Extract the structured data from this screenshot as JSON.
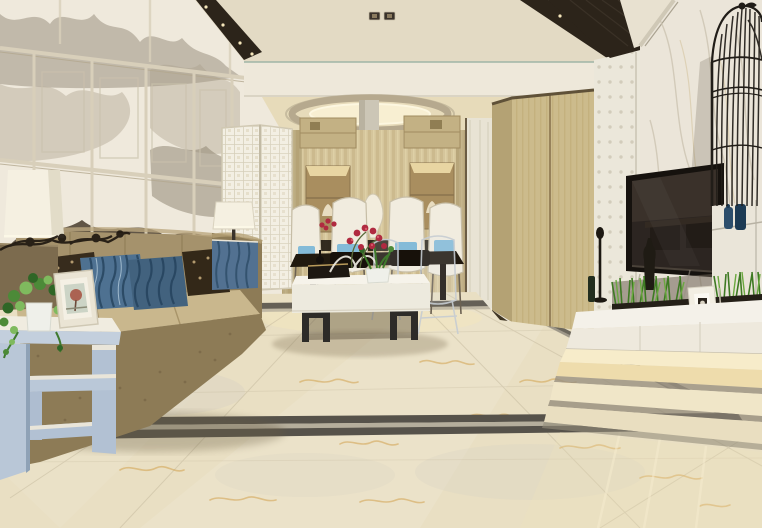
{
  "meta": {
    "scene": "modern-living-dining-room-interior-render",
    "style": "new-chinese-contemporary",
    "width_px": 762,
    "height_px": 528
  },
  "objects": [
    "tray-ceiling-downlights",
    "crystal-chandelier",
    "oval-ceiling-recess",
    "ink-mural-panel-wall",
    "white-lattice-screen",
    "table-lamp-left",
    "table-lamp-right",
    "fabric-sofa",
    "striped-blue-pillows",
    "patterned-dark-pillows",
    "geometric-side-table",
    "trailing-ivy-plant",
    "photo-frame",
    "white-coffee-table",
    "red-orchid-centerpiece",
    "books-tray",
    "dining-table",
    "white-highback-chairs",
    "acrylic-ghost-chairs",
    "wood-slat-feature-wall",
    "display-niches",
    "tall-white-vase",
    "wardrobe-cabinet",
    "textured-3d-column",
    "marble-tv-wall",
    "flat-screen-tv",
    "floating-tv-console",
    "wheatgrass-planter",
    "small-framed-art",
    "birdcage-decor-lamp",
    "blue-vases",
    "marble-floor",
    "dark-inlay-floor-border",
    "under-cabinet-glow"
  ],
  "palette": {
    "ceil": "#e3dac4",
    "ceilDark": "#2c241a",
    "bulk": "#eee8da",
    "diningCeil": "#e7dbba",
    "ovalRing": "#b6a98e",
    "glowWarm": "#f8efd2",
    "slat": "#d5c59b",
    "niche": "#a98e5f",
    "lattice": "#f3efe3",
    "mirror": "#e8e3d4",
    "ward": "#ccbb8c",
    "wardSide": "#b4a274",
    "column": "#ebe7da",
    "marble": "#ebe5d9",
    "marbleVein": "#cac2af",
    "tvFrame": "#16120e",
    "tvScr": "#2c2521",
    "cage": "#211d18",
    "vaseBlue1": "#2c4d6b",
    "vaseBlue2": "#1c3a54",
    "pedestal": "#eae5d9",
    "floor": "#e9dfc3",
    "floorLt": "#f2ead2",
    "vein": "#d2a24e",
    "grout": "#c3b89c",
    "inlay": "#56524a",
    "inlayLt": "#b5ae9c",
    "sofa": "#a5926c",
    "sofaSeat": "#c9b78d",
    "sofaBase": "#8d7b56",
    "pillowDark": "#372c1d",
    "pillowBlue": "#4e7191",
    "stripeDark": "#27455f",
    "stripeLt": "#a9c2d4",
    "cabBlue": "#527191",
    "shade": "#f5f0e1",
    "sideTable": "#b9c7d7",
    "slabWhite": "#f0ece0",
    "leaf": "#4c8a38",
    "leafDark": "#2f6626",
    "leafLt": "#7fba5e",
    "flower": "#b02a40",
    "flowerLt": "#d85a6a",
    "consoleWhite": "#f4f1e9",
    "grass": "#3e7a23",
    "grassLt": "#6aa83f",
    "plinth": "#f7ecca",
    "plinth2": "#eedcac",
    "chair": "#f1ecdf",
    "tableDark": "#20190f",
    "accentBlue": "#7fb9d8",
    "ink1": "#a99e8a",
    "ink2": "#8a7f6c",
    "ink3": "#463b2c",
    "panelFrame": "#d8cfba",
    "wallCream": "#efe9dc"
  }
}
